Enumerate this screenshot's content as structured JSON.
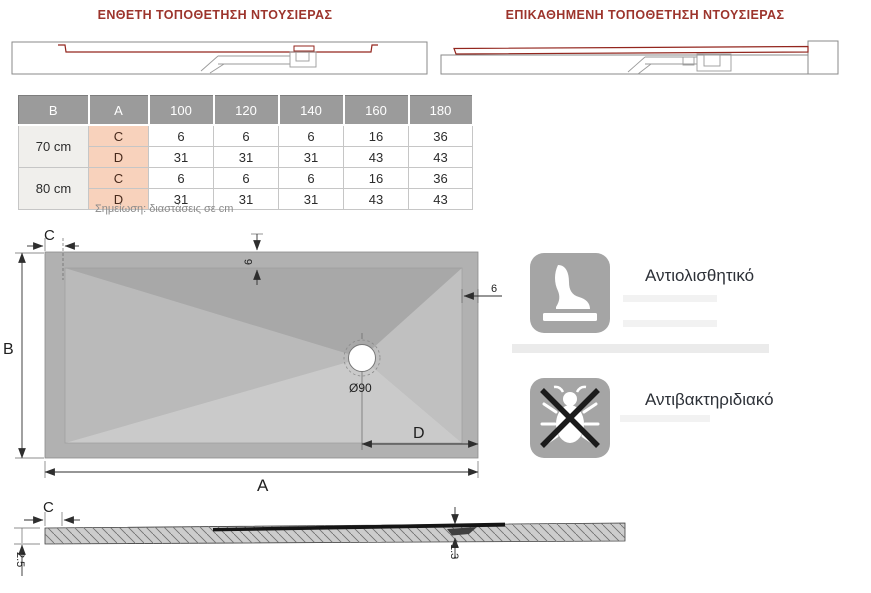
{
  "titles": {
    "inset": "ΕΝΘΕΤΗ ΤΟΠΟΘΕΤΗΣΗ ΝΤΟΥΣΙΕΡΑΣ",
    "overlay": "ΕΠΙΚΑΘΗΜΕΝΗ ΤΟΠΟΘΕΤΗΣΗ ΝΤΟΥΣΙΕΡΑΣ",
    "color": "#9c342c"
  },
  "table": {
    "headers": [
      "B",
      "A",
      "100",
      "120",
      "140",
      "160",
      "180"
    ],
    "row_labels": {
      "c": "C",
      "d": "D"
    },
    "rows": [
      {
        "size": "70 cm",
        "c": [
          "6",
          "6",
          "6",
          "16",
          "36"
        ],
        "d": [
          "31",
          "31",
          "31",
          "43",
          "43"
        ]
      },
      {
        "size": "80 cm",
        "c": [
          "6",
          "6",
          "6",
          "16",
          "36"
        ],
        "d": [
          "31",
          "31",
          "31",
          "43",
          "43"
        ]
      }
    ],
    "note": "Σημείωση: διαστάσεις σε cm",
    "colors": {
      "header_bg": "#9b9b9b",
      "header_text": "#ffffff",
      "size_cell_bg": "#f0efec",
      "cd_cell_bg": "#f8d2bc",
      "cd_text": "#47291b"
    }
  },
  "top_view": {
    "labels": {
      "a": "A",
      "b": "B",
      "c": "C",
      "d": "D",
      "drain": "Ø90",
      "border_top": "6",
      "border_right": "6"
    }
  },
  "features": [
    {
      "icon": "foot-icon",
      "label": "Αντιολισθητικό"
    },
    {
      "icon": "no-bacteria-icon",
      "label": "Αντιβακτηριδιακό"
    }
  ],
  "feature_icon_color": "#a5a5a5",
  "cross_section": {
    "labels": {
      "c": "C",
      "thickness": "2.5",
      "drain_depth": "1.3"
    }
  },
  "drawing_accent_color": "#93261e"
}
